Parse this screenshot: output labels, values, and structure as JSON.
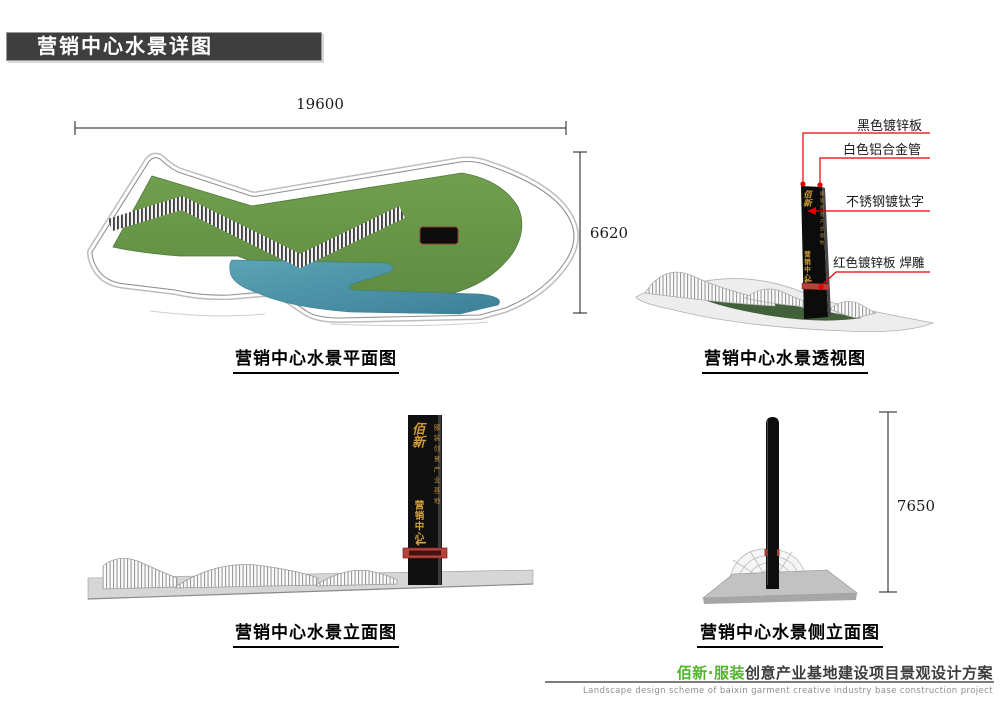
{
  "page": {
    "title": "营销中心水景详图"
  },
  "views": {
    "plan": {
      "caption": "营销中心水景平面图",
      "dim_width": "19600",
      "dim_height": "6620"
    },
    "perspective": {
      "caption": "营销中心水景透视图",
      "annotations": [
        "黑色镀锌板",
        "白色铝合金管",
        "不锈钢镀钛字",
        "红色镀锌板 焊雕"
      ]
    },
    "elevation": {
      "caption": "营销中心水景立面图"
    },
    "side_elevation": {
      "caption": "营销中心水景侧立面图",
      "dim_height": "7650"
    }
  },
  "signpost": {
    "brand": "佰新",
    "tagline": "服装创意产业基地",
    "label": "营销中心",
    "arrow": "←"
  },
  "footer": {
    "brand": "佰新·服装",
    "title": "创意产业基地建设项目景观设计方案",
    "subtitle": "Landscape design scheme of baixin garment creative industry base construction project"
  },
  "colors": {
    "grass": "#6b9a4a",
    "water": "#4b93a8",
    "annotation_red": "#e60000",
    "gold": "#d19a36",
    "band_red": "#b5433b",
    "footer_green": "#52b62e",
    "banner_gray": "#3e3e3e"
  }
}
